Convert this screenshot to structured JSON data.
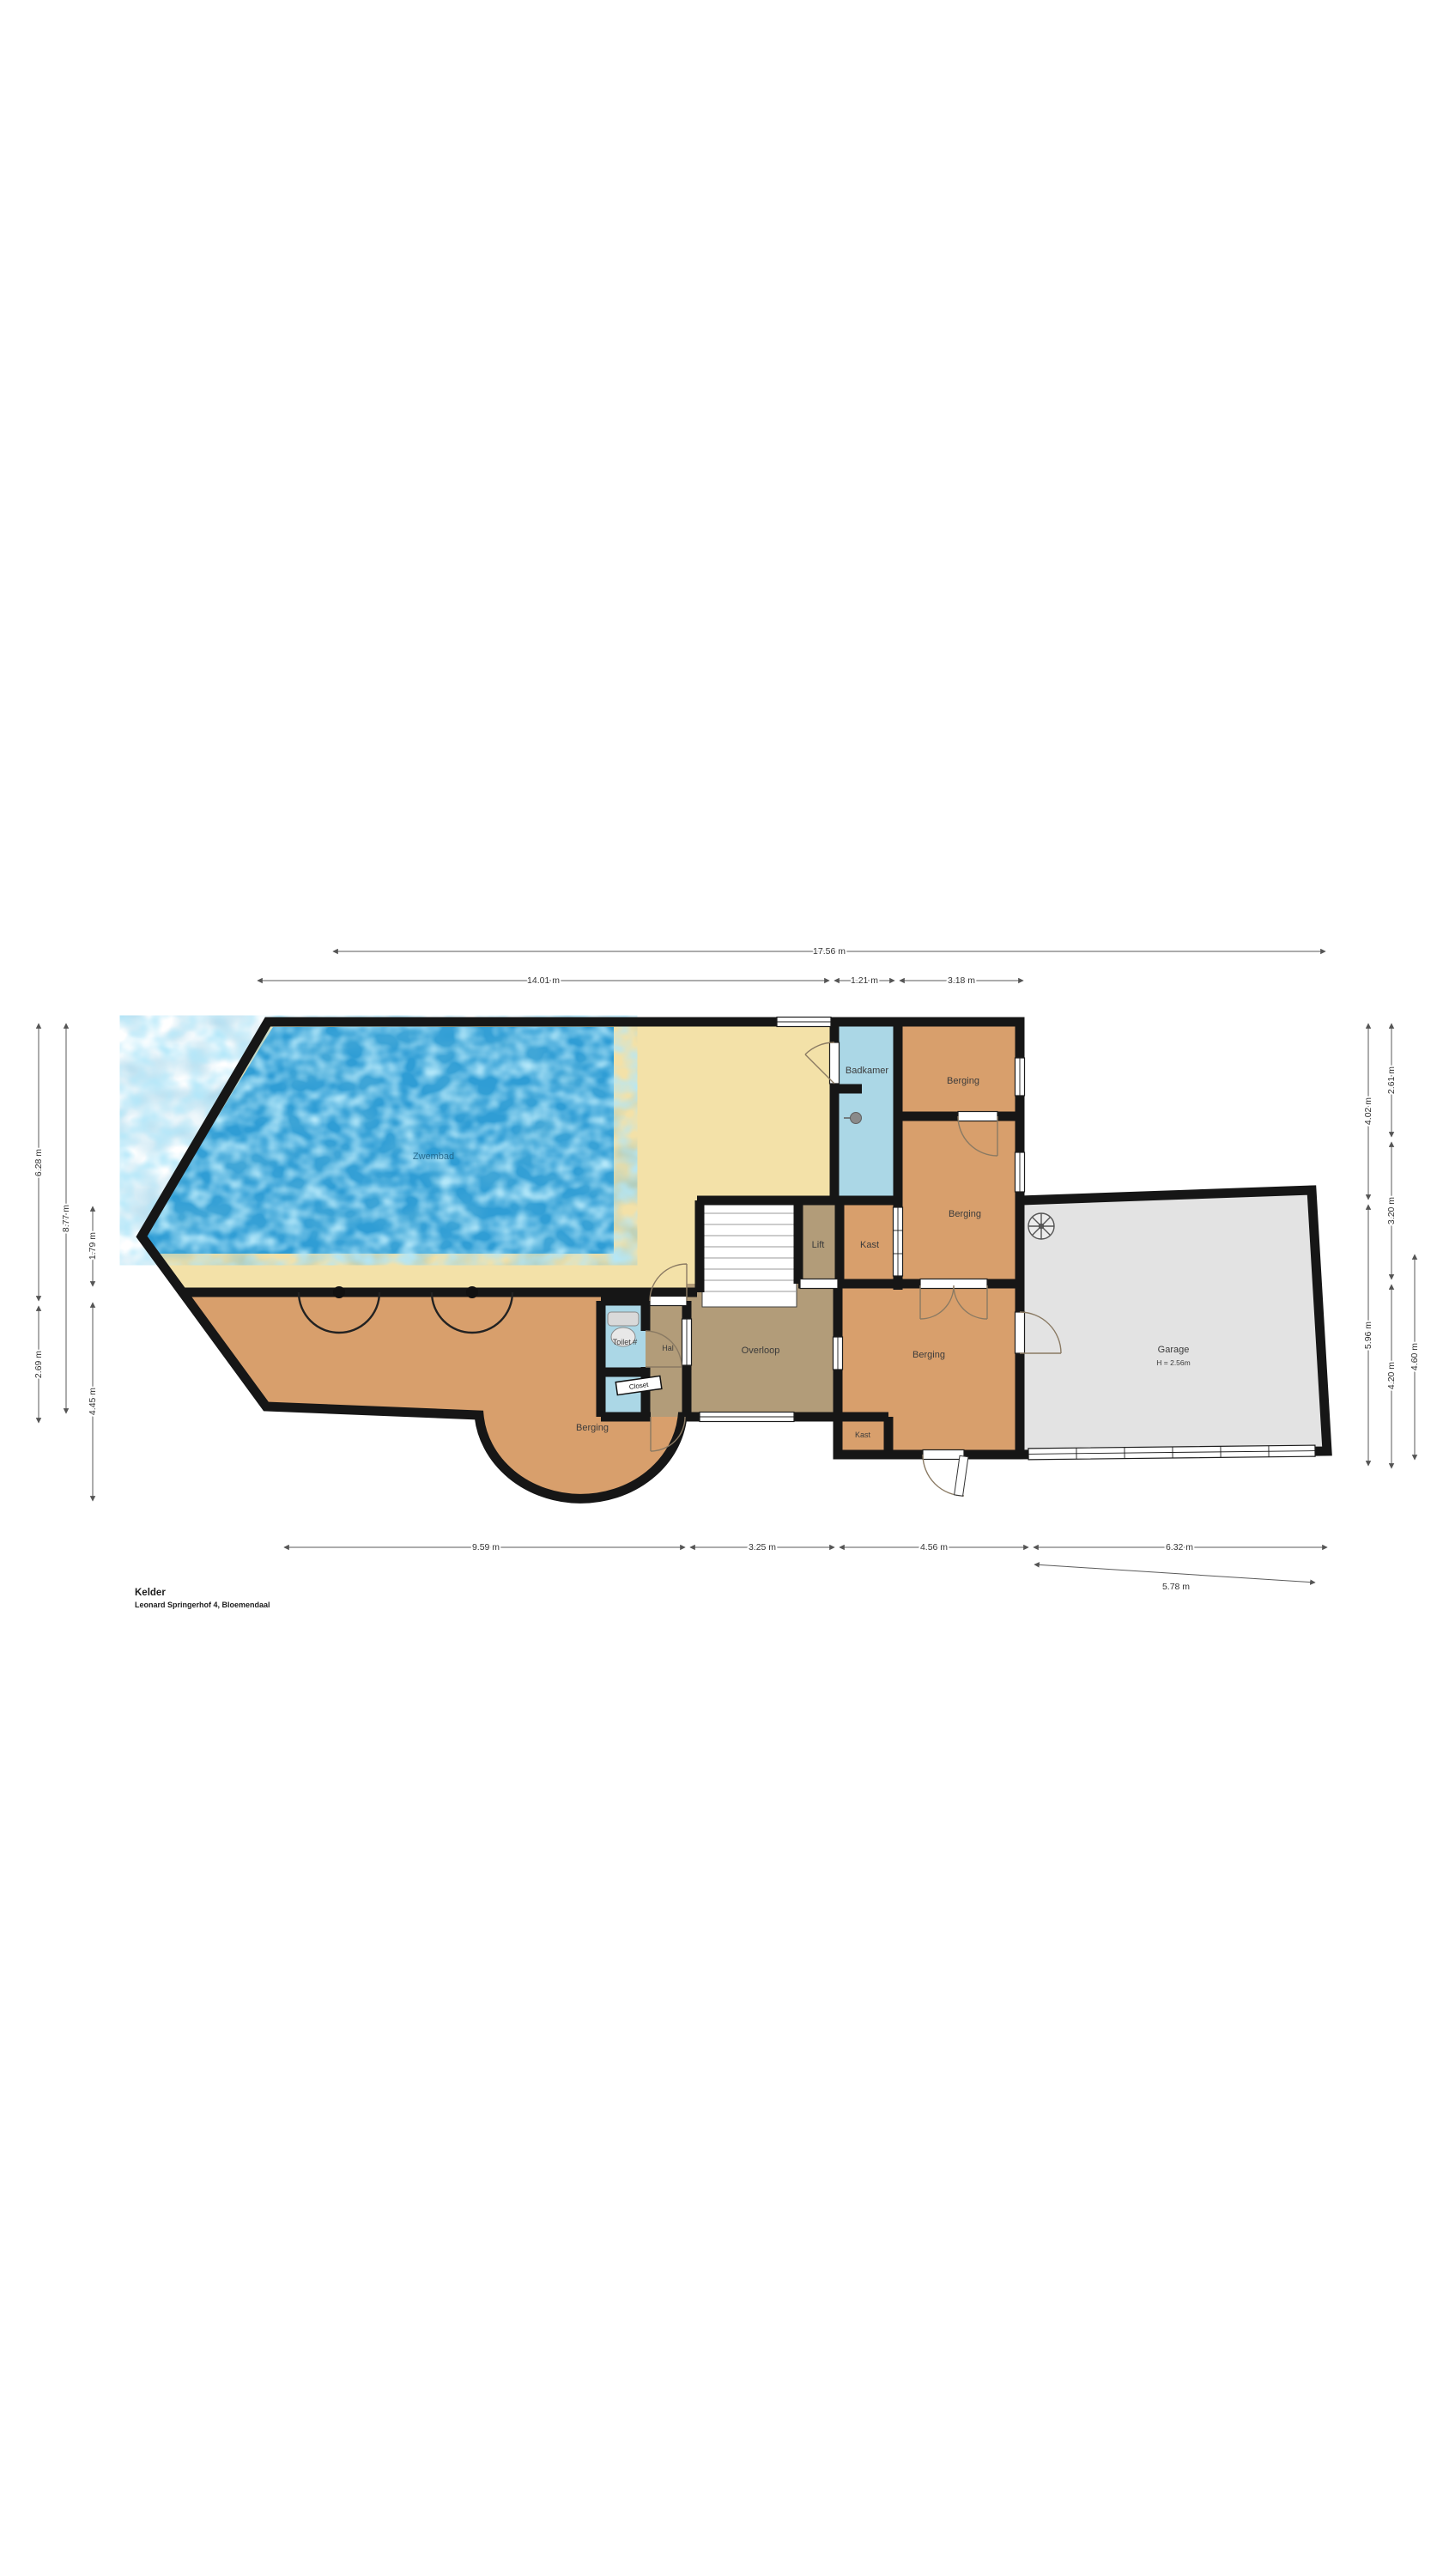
{
  "page": {
    "title": "Kelder",
    "subtitle": "Leonard Springerhof 4, Bloemendaal"
  },
  "rooms": {
    "zwembad": "Zwembad",
    "badkamer": "Badkamer",
    "berging_top": "Berging",
    "berging_mid": "Berging",
    "berging_main": "Berging",
    "berging_pool": "Berging",
    "kast": "Kast",
    "kast_small": "Kast",
    "lift": "Lift",
    "overloop": "Overloop",
    "hal": "Hal",
    "toilet": "Toilet #",
    "closet": "Closet",
    "garage": "Garage",
    "garage_height": "H = 2.56m"
  },
  "dimensions": {
    "top_total": "17.56 m",
    "top_seg1": "14.01 m",
    "top_seg2": "1.21 m",
    "top_seg3": "3.18 m",
    "bottom_seg1": "9.59 m",
    "bottom_seg2": "3.25 m",
    "bottom_seg3": "4.56 m",
    "bottom_seg4": "6.32 m",
    "bottom_garage_door": "5.78 m",
    "left_outer_top": "6.28 m",
    "left_outer_bottom": "2.69 m",
    "left_middle": "8.77 m",
    "left_inner_top": "1.79 m",
    "left_inner_bottom": "4.45 m",
    "right_inner_top": "4.02 m",
    "right_inner_bottom": "5.96 m",
    "right_mid_top": "2.61 m",
    "right_mid_mid": "3.20 m",
    "right_mid_bottom": "4.20 m",
    "right_outer": "4.60 m"
  },
  "icons": {
    "boiler_icon": "circle-with-radial-spokes",
    "pool_column_icon": "black-dot-column",
    "bath_drain_icon": "gray-drain-circle",
    "toilet_fixture_icon": "toilet-tank-and-bowl"
  },
  "colors": {
    "wall": "#161616",
    "deck": "#f3e1a8",
    "water": "#2f9dd5",
    "salmon": "#d89f6c",
    "brown": "#b29c79",
    "lightblue": "#abd7e6",
    "garage": "#e3e3e3",
    "dim": "#5a5a5a",
    "dimtext": "#333333",
    "label": "#3b3b3b"
  }
}
